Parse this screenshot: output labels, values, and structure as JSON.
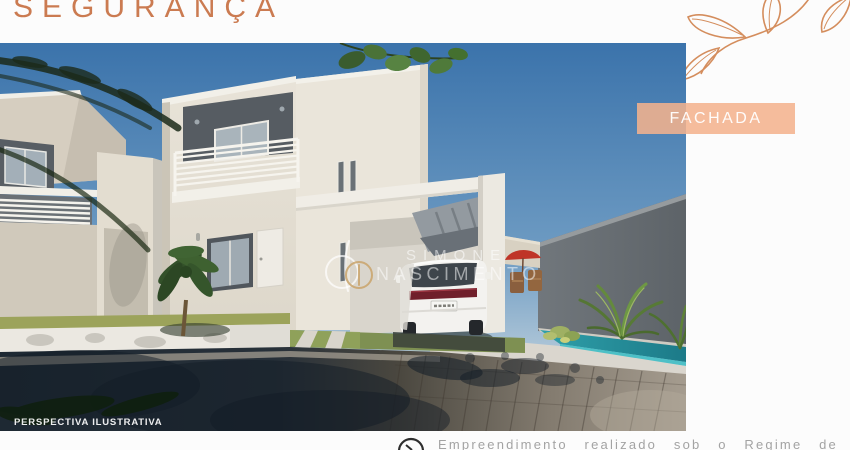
{
  "header": {
    "title": "SEGURANÇA"
  },
  "image_label": {
    "text": "FACHADA"
  },
  "photo": {
    "caption": "PERSPECTIVA ILUSTRATIVA",
    "watermark": {
      "line1": "SIMONE",
      "line2": "NASCIMENTO"
    }
  },
  "footer": {
    "text": "Empreendimento realizado sob o Regime de"
  },
  "colors": {
    "title_orange": "#CB7B51",
    "label_peach": "#F2B28C",
    "leaf_decoration_orange": "#D0824C",
    "footer_gray": "#A3A3A3",
    "sky_blue": "#3B73AB",
    "pool_teal": "#2FA0AA",
    "umbrella_red": "#BF3427"
  }
}
